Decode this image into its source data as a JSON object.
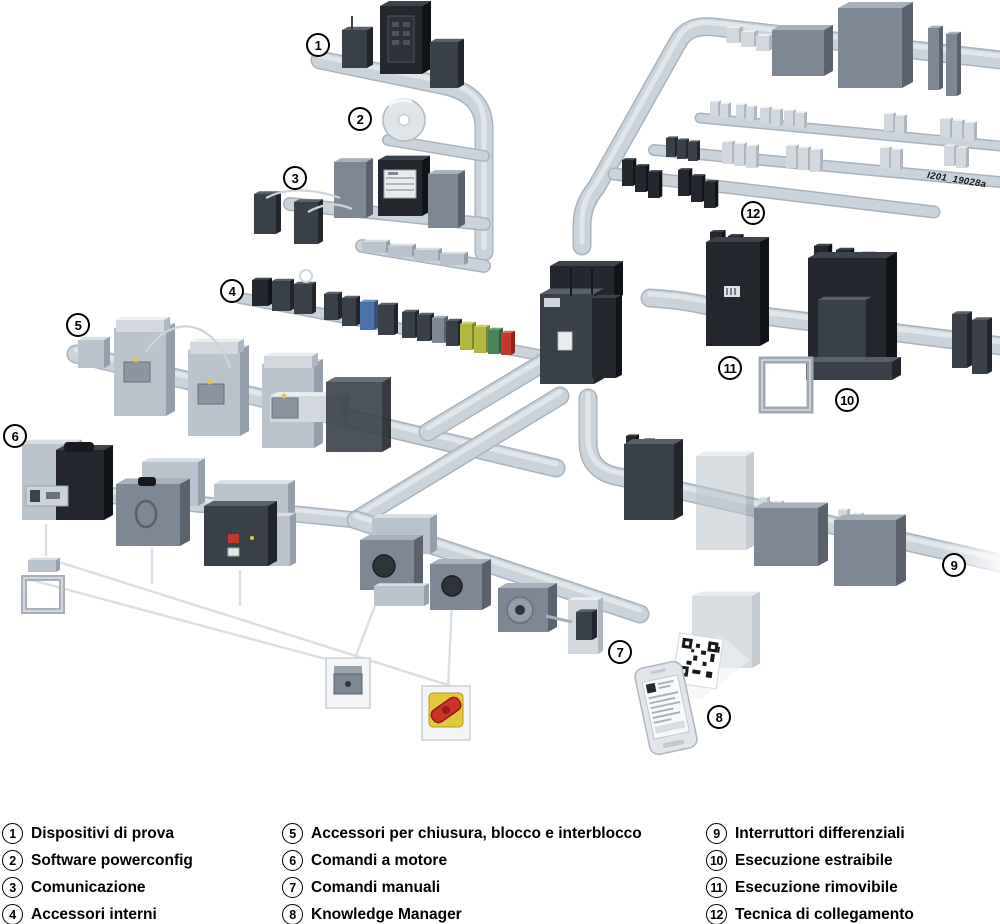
{
  "watermark": "I201_19028a",
  "legend": {
    "columns": [
      {
        "items": [
          {
            "num": "1",
            "label": "Dispositivi di prova"
          },
          {
            "num": "2",
            "label": "Software powerconfig"
          },
          {
            "num": "3",
            "label": "Comunicazione"
          },
          {
            "num": "4",
            "label": "Accessori interni"
          }
        ]
      },
      {
        "items": [
          {
            "num": "5",
            "label": "Accessori per chiusura, blocco e interblocco"
          },
          {
            "num": "6",
            "label": "Comandi a motore"
          },
          {
            "num": "7",
            "label": "Comandi manuali"
          },
          {
            "num": "8",
            "label": "Knowledge Manager"
          }
        ]
      },
      {
        "items": [
          {
            "num": "9",
            "label": "Interruttori differenziali"
          },
          {
            "num": "10",
            "label": "Esecuzione estraibile"
          },
          {
            "num": "11",
            "label": "Esecuzione rimovibile"
          },
          {
            "num": "12",
            "label": "Tecnica di collegamento"
          }
        ]
      }
    ]
  },
  "callouts": [
    {
      "num": "1",
      "x": 318,
      "y": 45
    },
    {
      "num": "2",
      "x": 360,
      "y": 119
    },
    {
      "num": "3",
      "x": 295,
      "y": 178
    },
    {
      "num": "4",
      "x": 232,
      "y": 291
    },
    {
      "num": "5",
      "x": 78,
      "y": 325
    },
    {
      "num": "6",
      "x": 15,
      "y": 436
    },
    {
      "num": "7",
      "x": 620,
      "y": 652
    },
    {
      "num": "8",
      "x": 719,
      "y": 717
    },
    {
      "num": "9",
      "x": 954,
      "y": 565
    },
    {
      "num": "10",
      "x": 847,
      "y": 400
    },
    {
      "num": "11",
      "x": 730,
      "y": 368
    },
    {
      "num": "12",
      "x": 753,
      "y": 213
    }
  ],
  "colors": {
    "background": "#ffffff",
    "pipe": "#cad2da",
    "pipe_edge": "#a9b3bd",
    "device_black": "#24282e",
    "device_dark": "#3a4048",
    "device_mid": "#7e8794",
    "device_light": "#bac2cc",
    "accent_blue": "#4a72ad",
    "accent_red": "#c3392e",
    "accent_yellow": "#e2c83b",
    "accent_olive": "#b2b73e",
    "accent_green": "#47825b"
  },
  "icons": [
    "cd-disc-icon",
    "qr-code-icon",
    "smartphone-icon",
    "emergency-stop-handle-icon",
    "door-frame-icon",
    "antenna-icon"
  ]
}
